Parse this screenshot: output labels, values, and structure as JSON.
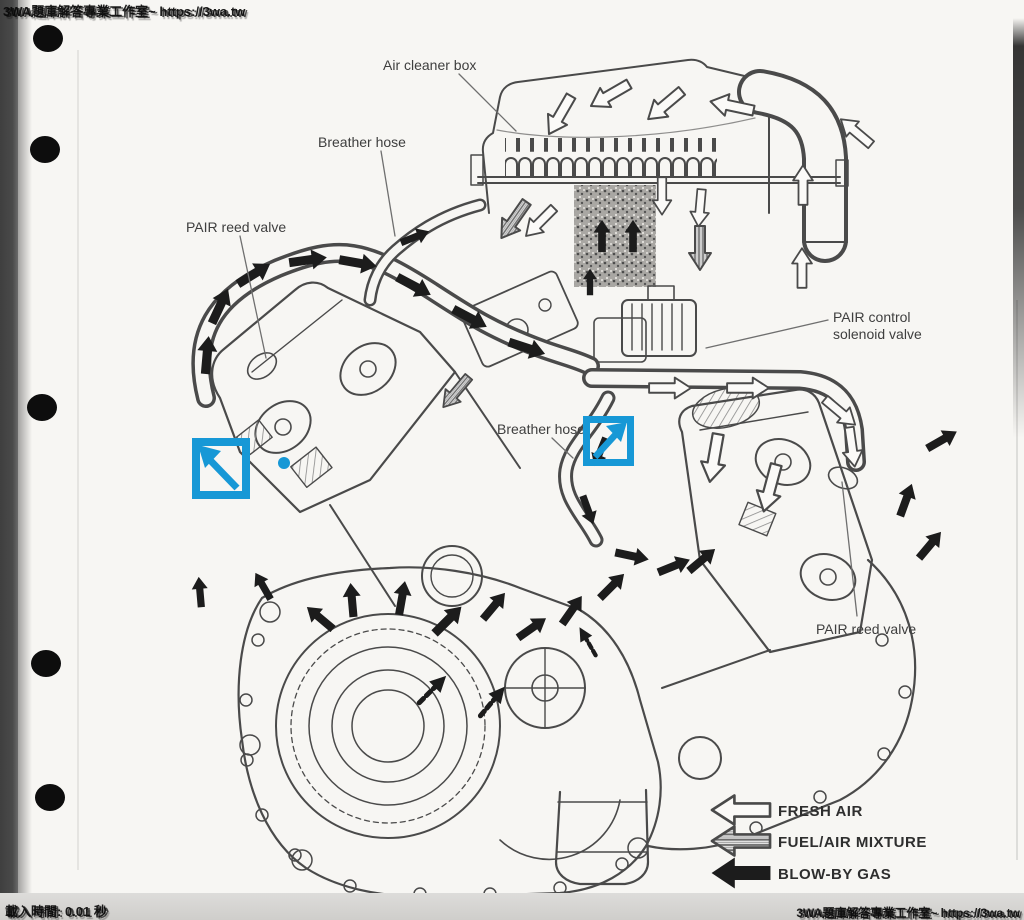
{
  "overlay": {
    "watermark": "3WA題庫解答專業工作室~ https://3wa.tw",
    "load_time": "載入時間: 0.01 秒",
    "accent_blue": "#1798d6"
  },
  "diagram": {
    "labels": {
      "air_cleaner_box": "Air cleaner box",
      "breather_hose_top": "Breather hose",
      "pair_reed_valve_left": "PAIR reed valve",
      "pair_control_line1": "PAIR control",
      "pair_control_line2": "solenoid valve",
      "breather_hose_mid": "Breather hose",
      "pair_reed_valve_right": "PAIR reed valve"
    },
    "legend": [
      {
        "style": "outline",
        "label": "FRESH AIR"
      },
      {
        "style": "striped",
        "label": "FUEL/AIR MIXTURE"
      },
      {
        "style": "solid",
        "label": "BLOW-BY GAS"
      }
    ]
  },
  "annotations": {
    "arrow_box_left": {
      "shape": "square-arrow",
      "direction": "up-left"
    },
    "arrow_box_right": {
      "shape": "square-arrow",
      "direction": "up-right"
    },
    "dot": {
      "shape": "dot",
      "color": "#1798d6"
    }
  }
}
